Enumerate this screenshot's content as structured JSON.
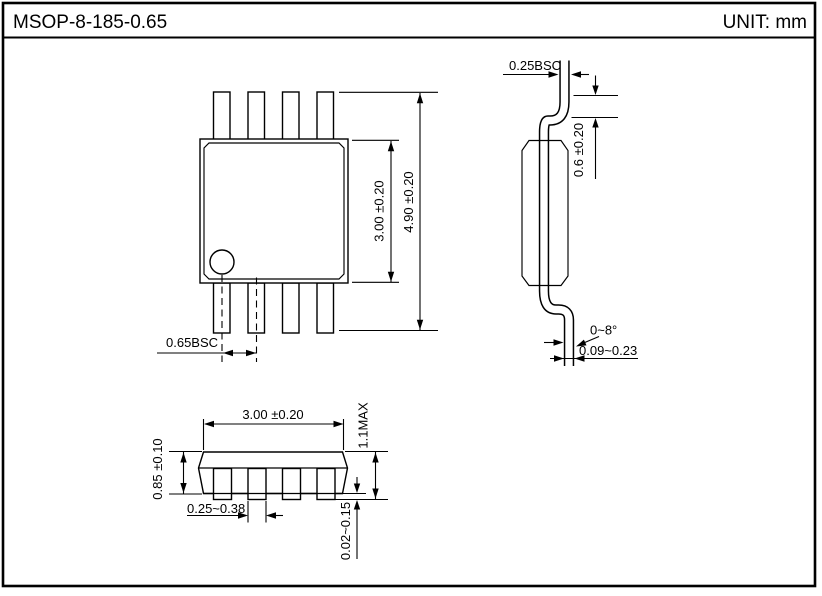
{
  "header": {
    "title": "MSOP-8-185-0.65",
    "unit": "UNIT: mm"
  },
  "top_view": {
    "dim_overall": "4.90 ±0.20",
    "dim_body": "3.00 ±0.20",
    "dim_pitch": "0.65BSC"
  },
  "side_view": {
    "dim_lead_thickness": "0.25BSC",
    "dim_foot_length": "0.6 ±0.20",
    "dim_foot_angle": "0~8°",
    "dim_foot_thickness": "0.09~0.23"
  },
  "front_view": {
    "dim_body_width": "3.00 ±0.20",
    "dim_height_max": "1.1MAX",
    "dim_body_thickness": "0.85 ±0.10",
    "dim_lead_width": "0.25~0.38",
    "dim_standoff": "0.02~0.15"
  },
  "colors": {
    "line": "#000000",
    "background": "#ffffff"
  }
}
